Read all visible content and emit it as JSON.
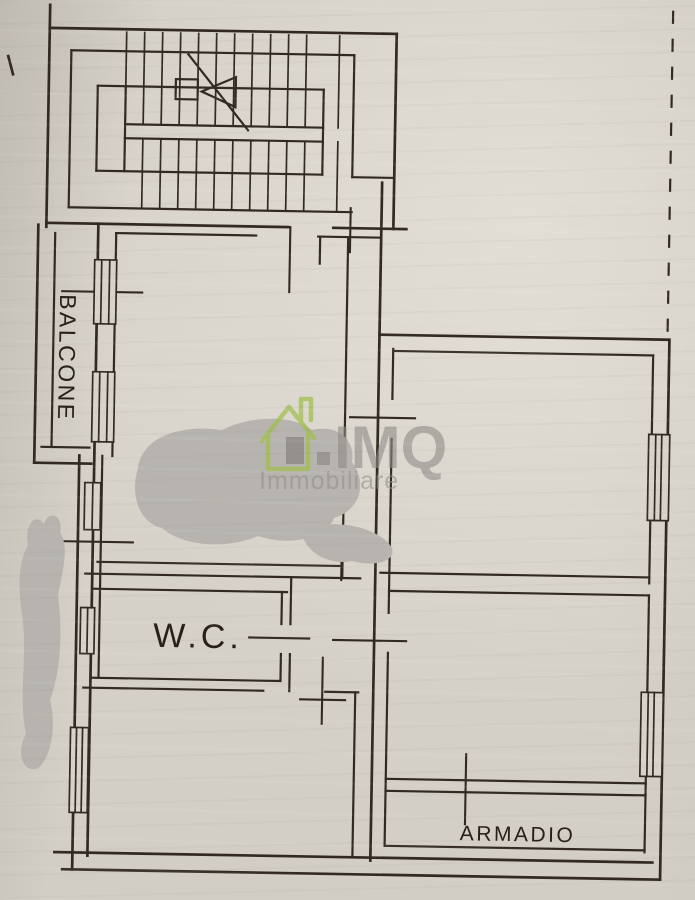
{
  "plan": {
    "labels": {
      "balcony": "BALCONE",
      "wc": "W.C.",
      "wardrobe": "ARMADIO"
    }
  },
  "watermark": {
    "brand": "IMQ",
    "subtitle": "Immobiliare"
  },
  "colors": {
    "ink": "#322a21",
    "paper": "#d7d3cb",
    "watermark_green": "#9fbf49",
    "watermark_gray": "#8e8b87",
    "redaction_gray": "#b7b4af"
  }
}
